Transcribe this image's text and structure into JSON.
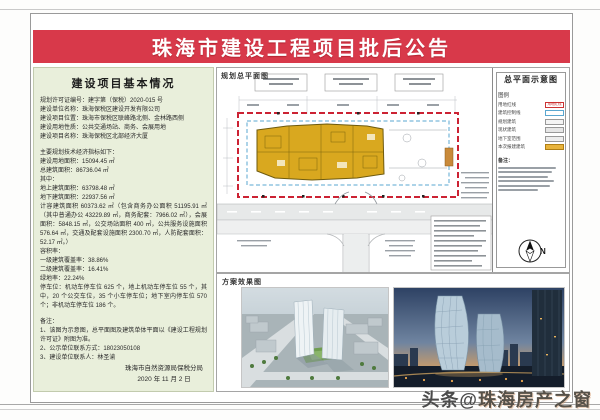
{
  "banner": {
    "title": "珠海市建设工程项目批后公告"
  },
  "left_panel": {
    "title": "建设项目基本情况",
    "lines": [
      "规划许可证编号：建字第（保税）2020-015 号",
      "建设单位名称：珠海保税区建设开发有限公司",
      "建设项目位置：珠海市保税区联峰路北侧、金林路西侧",
      "建设用地性质：公共交通场站、商务、会展用地",
      "建设项目名称：珠海保税区北部经济大厦",
      "",
      "主要规划技术经济指标如下：",
      "建设用地面积：15094.45 ㎡",
      "总建筑面积：86736.04 ㎡",
      "其中：",
      "地上建筑面积：63798.48 ㎡",
      "地下建筑面积：22937.56 ㎡",
      "计容建筑面积 60373.62 ㎡（包含商务办公面积 51195.91 ㎡（其中普通办公 43229.89 ㎡，商务配套：7966.02 ㎡），会展面积：5848.15 ㎡，公交场站面积 400 ㎡，公共服务设施面积 576.64 ㎡，交通及配套设施面积 2300.70 ㎡，人防配套面积：52.17 ㎡。）",
      "容积率：",
      "一级建筑覆盖率：38.86%",
      "二级建筑覆盖率：16.41%",
      "绿地率：22.24%",
      "停车位：机动车停车位 625 个，地上机动车停车位 55 个，其中，20 个公交车位，35 个小车停车位；地下室内停车位 570 个；非机动车停车位 186 个。",
      "",
      "备注：",
      "1、该图为示意图，总平面图及建筑单体平面以《建设工程规划许可证》附图为准。",
      "2、公示单位联系方式：18023050108",
      "3、建设单位联系人：林圣渝"
    ],
    "agency": "珠海市自然资源局保税分局",
    "date": "2020 年 11 月 2 日"
  },
  "site_plan": {
    "label": "规划总平面图"
  },
  "legend_panel": {
    "title": "总平面示意图",
    "legend_label": "图例",
    "items": [
      {
        "label": "用地红线",
        "chip_text": "用地红线",
        "fill": "#ffffff",
        "border": "#cc3333"
      },
      {
        "label": "建筑控制线",
        "chip_text": "",
        "fill": "#ffffff",
        "border": "#5aa7d0"
      },
      {
        "label": "规划建筑",
        "chip_text": "",
        "fill": "#f4f4f4",
        "border": "#999999"
      },
      {
        "label": "现状建筑",
        "chip_text": "",
        "fill": "#e6e6e6",
        "border": "#999999"
      },
      {
        "label": "地下室范围",
        "chip_text": "",
        "fill": "#ededed",
        "border": "#999999"
      },
      {
        "label": "本次报建建筑",
        "chip_text": "",
        "fill": "#e8b33c",
        "border": "#b07f14"
      }
    ],
    "notes_label": "备注：",
    "note_bar_widths": [
      58,
      54,
      50,
      56,
      52,
      40
    ],
    "north_label": "N"
  },
  "renders": {
    "label": "方案效果图"
  },
  "watermark": {
    "prefix": "头条@",
    "brand": "珠海房产之窗"
  },
  "colors": {
    "banner_red": "#d8394a",
    "panel_green": "#e9efdb",
    "parcel_red_line": "#cc2233",
    "setback_blue_line": "#5aa7d0",
    "building_yellow": "#d9a81f"
  }
}
